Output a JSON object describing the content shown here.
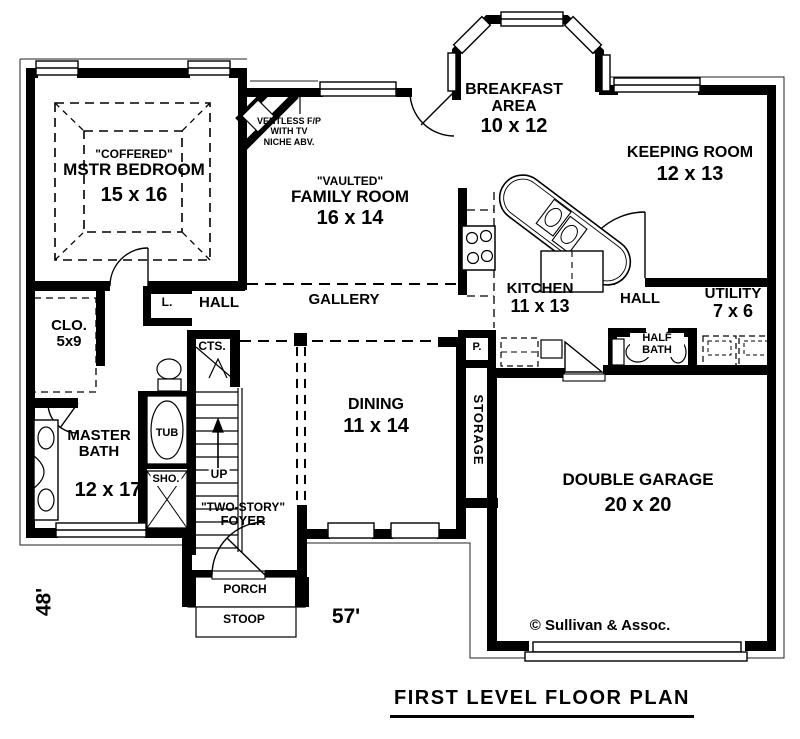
{
  "plan": {
    "title": "FIRST LEVEL FLOOR PLAN",
    "copyright": "© Sullivan & Assoc.",
    "width_label": "57'",
    "depth_label": "48'"
  },
  "rooms": {
    "mstr_bedroom": {
      "note": "\"COFFERED\"",
      "name": "MSTR BEDROOM",
      "size": "15 x 16"
    },
    "family_room": {
      "note": "\"VAULTED\"",
      "name": "FAMILY ROOM",
      "size": "16 x 14"
    },
    "breakfast_area": {
      "name": "BREAKFAST AREA",
      "size": "10 x 12"
    },
    "keeping_room": {
      "name": "KEEPING ROOM",
      "size": "12 x 13"
    },
    "kitchen": {
      "name": "KITCHEN",
      "size": "11 x 13"
    },
    "utility": {
      "name": "UTILITY",
      "size": "7 x 6"
    },
    "half_bath": {
      "name": "HALF BATH"
    },
    "master_bath": {
      "name": "MASTER BATH",
      "size": "12 x 17"
    },
    "closet": {
      "name": "CLO.",
      "size": "5x9"
    },
    "dining": {
      "name": "DINING",
      "size": "11 x 14"
    },
    "storage": {
      "name": "STORAGE"
    },
    "garage": {
      "name": "DOUBLE GARAGE",
      "size": "20 x 20"
    },
    "foyer": {
      "note": "\"TWO-STORY\"",
      "name": "FOYER"
    },
    "gallery": {
      "name": "GALLERY"
    },
    "hall_left": {
      "name": "HALL"
    },
    "hall_right": {
      "name": "HALL"
    },
    "porch": {
      "name": "PORCH"
    },
    "stoop": {
      "name": "STOOP"
    }
  },
  "annotations": {
    "fireplace": [
      "VENTLESS F/P",
      "WITH TV",
      "NICHE ABV."
    ],
    "linen_closet": "L.",
    "coat_closet": "CTS.",
    "pantry": "P.",
    "tub": "TUB",
    "shower": "SHO.",
    "stairs_direction": "UP"
  },
  "colors": {
    "wall": "#000000",
    "background": "#ffffff",
    "text": "#000000"
  }
}
